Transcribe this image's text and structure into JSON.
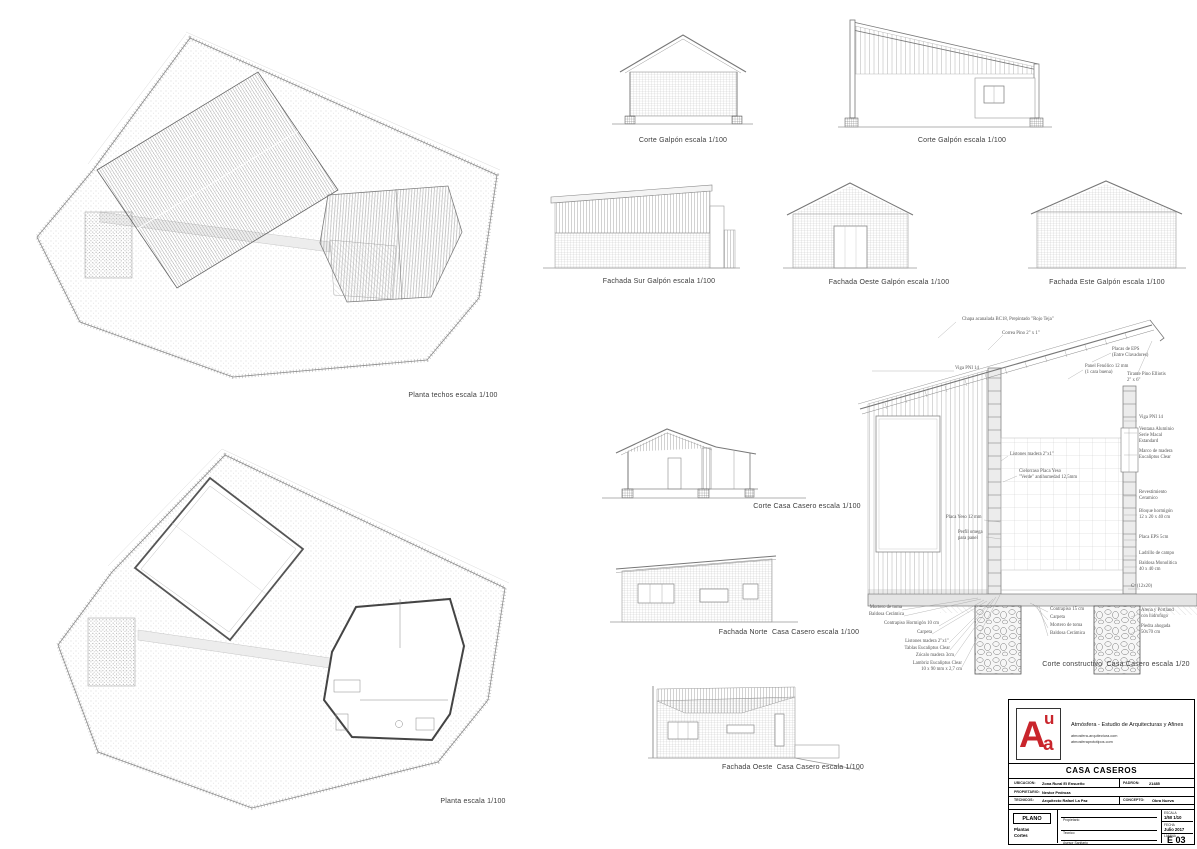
{
  "captions": {
    "planta_techos": "Planta techos escala 1/100",
    "planta": "Planta escala 1/100",
    "corte_galpon_a": "Corte Galpón escala 1/100",
    "corte_galpon_b": "Corte Galpón escala 1/100",
    "fachada_sur_galpon": "Fachada Sur Galpón escala 1/100",
    "fachada_oeste_galpon": "Fachada Oeste Galpón escala 1/100",
    "fachada_este_galpon": "Fachada Este Galpón escala 1/100",
    "corte_casa": "Corte Casa Casero escala 1/100",
    "fachada_norte_casa": "Fachada Norte  Casa Casero escala 1/100",
    "fachada_oeste_casa": "Fachada Oeste  Casa Casero escala 1/100",
    "corte_constructivo": "Corte constructivo  Casa Casero escala 1/20"
  },
  "detail": {
    "top": [
      "Chapa acanalada BC18, Prepintado \"Rojo Teja\"",
      "Correa Pino 2\" x 1\"",
      "Placas de EPS\n(Entre Clavadores)",
      "Panel Fenólico 12 mm\n(1 cara buena)",
      "Tirante Pino Elliotis\n2\" x 6\""
    ],
    "left": [
      "Viga PNI 14",
      "Listones madera 2\"x1\"",
      "Cielorraso Placa Yeso\n\"Verde\" antihumedad 12,5mm",
      "Placa Yeso 12 mm",
      "Perfil omega\npara panel"
    ],
    "right": [
      "Viga PNI 14",
      "Ventana Aluminio\nSerie Macal\nEstandard",
      "Marco de madera\nEucaliptus Clear",
      "Revestimiento\nCeramico",
      "Bloque hormigón\n12 x 20 x 40 cm",
      "Placa EPS 5cm",
      "Ladrillo de campo",
      "Baldosa Monolitica\n40 x 40 cm",
      "Cº (12x20)"
    ],
    "bottom_left": [
      "Mortero de toma",
      "Baldosa Cerámica",
      "Contrapiso Hormigón 10 cm",
      "Carpeta",
      "Listones madera 2\"x1\"",
      "Tablas Eucaliptus Clear",
      "Zócalo madera 3cm",
      "Lambriz Eucaliptus Clear\n10 x 90 mm x 2,7 cm"
    ],
    "bottom_center": [
      "Contrapiso 15 cm",
      "Carpeta",
      "Mortero de toma",
      "Baldosa Cerámica"
    ],
    "bottom_right": [
      "Arena y Portland\ncon hidrofugo",
      "Piedra ahogada\n50x70 cm"
    ]
  },
  "titleblock": {
    "accent_color": "#c9252c",
    "logo": {
      "a_big": "A",
      "u": "u",
      "a_small": "a"
    },
    "firm": "Atmósfera - Estudio de Arquitecturas y Afines",
    "web1": "atmosfera-arquitectura.com",
    "web2": "atmosferaprototipos.com",
    "project": "CASA CASEROS",
    "ubicacion_label": "UBICACION:",
    "ubicacion": "Zona Rural El Ensueño",
    "padron_label": "PADRON:",
    "padron": "21485",
    "propietario_label": "PROPIETARIO:",
    "propietario": "Nestor Pedroza",
    "tecnicos_label": "TECNICOS:",
    "tecnicos": "Arquitecto Rafael La Paz",
    "concepto_label": "CONCEPTO:",
    "concepto": "Obra Nueva",
    "plano_label": "PLANO",
    "plano_content": "Plantas\nCortes",
    "sign_propietario": "Propietario",
    "sign_tecnico": "Tecnico",
    "sign_asesor": "Asesor Sanitario",
    "escala_label": "ESCALA",
    "escala": "1/50  1/10",
    "fecha_label": "FECHA",
    "fecha": "Julio 2017",
    "lamina_label": "LAMINA",
    "lamina": "E 03"
  }
}
